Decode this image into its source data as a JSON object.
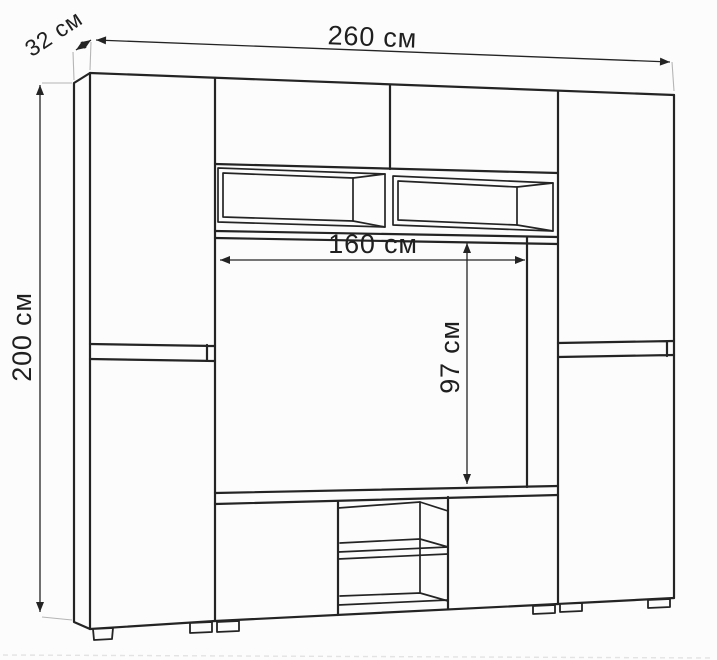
{
  "diagram": {
    "type": "furniture-dimension-drawing",
    "subject": "wall unit with TV niche, side wardrobes and TV stand",
    "colors": {
      "background": "#fcfcfc",
      "line": "#242424",
      "dimension_line": "#242424",
      "extension_line": "#b5b5b5",
      "text": "#1f1f1f"
    },
    "labels": {
      "total_width": "260 см",
      "depth": "32 см",
      "total_height": "200 см",
      "niche_width": "160 см",
      "niche_height": "97 см"
    }
  }
}
